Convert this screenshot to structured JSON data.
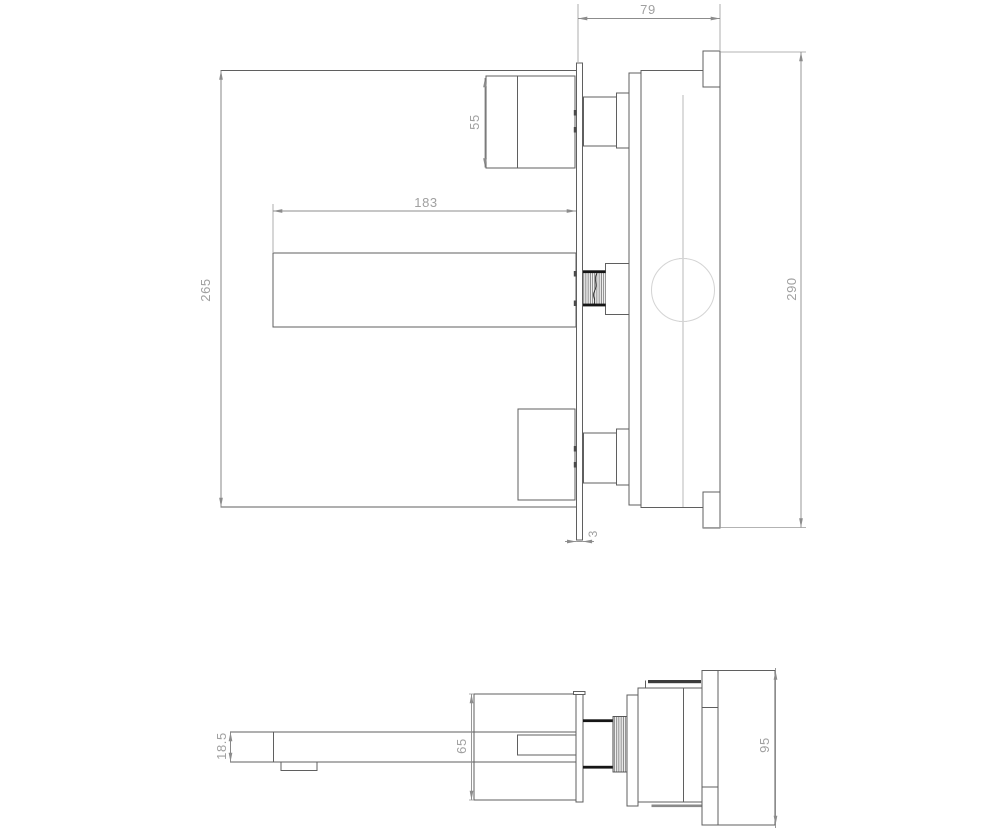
{
  "drawing": {
    "subject": "wall-mounted basin mixer faucet technical drawing, front/side view and bottom view",
    "units": "mm",
    "dims": {
      "d79": "79",
      "d55": "55",
      "d183": "183",
      "d265": "265",
      "d290": "290",
      "d3": "3",
      "d18_5": "18.5",
      "d65": "65",
      "d95": "95"
    },
    "colors": {
      "background": "#ffffff",
      "part_line": "#5f5f5f",
      "dim_line": "#8c8c8c",
      "dim_text": "#a0a0a0",
      "thread_dark": "#161616",
      "circle_light": "#d4d4d4"
    }
  }
}
